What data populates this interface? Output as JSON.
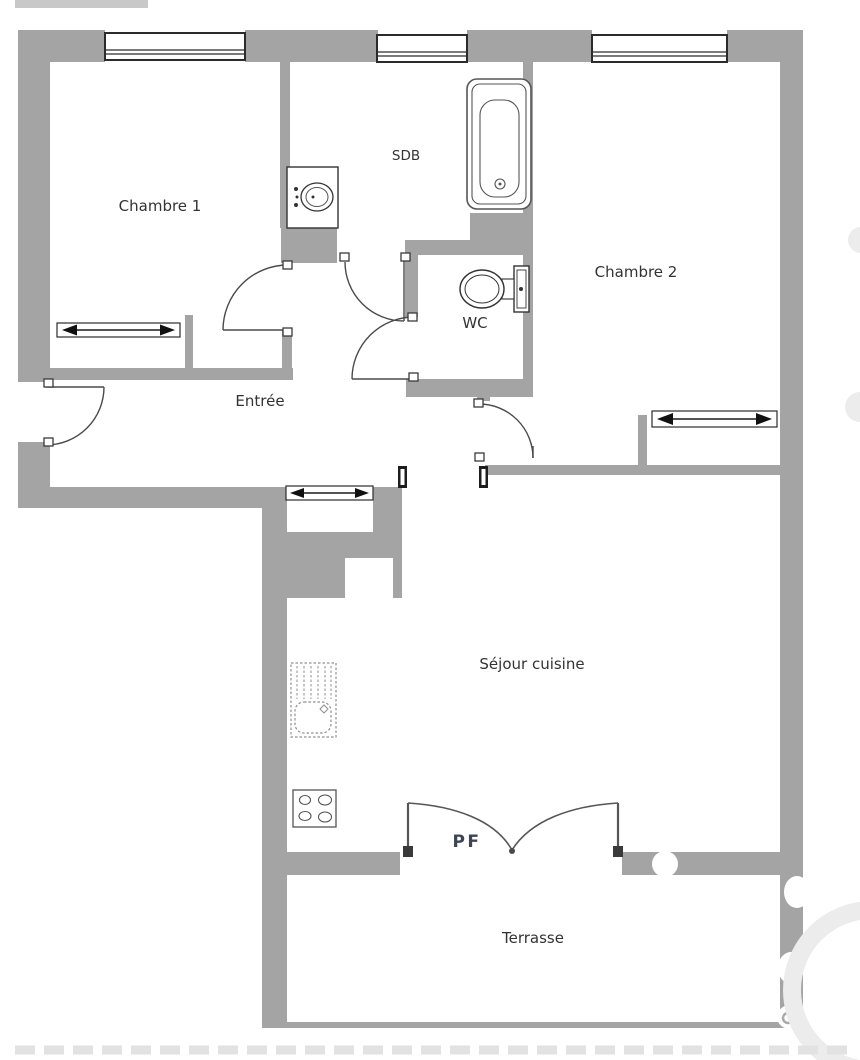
{
  "title": "Apartment floor plan",
  "colors": {
    "wall": "#a4a4a4",
    "line": "#4a4a4a",
    "label": "#333333",
    "pf_label": "#3f4455",
    "background": "#ffffff"
  },
  "rooms": {
    "chambre1": "Chambre 1",
    "sdb": "SDB",
    "chambre2": "Chambre 2",
    "wc": "WC",
    "entree": "Entrée",
    "sejour": "Séjour cuisine",
    "terrasse": "Terrasse"
  },
  "annotations": {
    "french_door": "PF"
  },
  "fixtures": {
    "bathtub-icon": "bathtub",
    "washbasin-icon": "washbasin",
    "toilet-icon": "toilet",
    "kitchen-sink-icon": "kitchen sink with drainer",
    "cooktop-icon": "4-burner cooktop",
    "sliding-wardrobe-icon": "sliding-door wardrobe (double arrow)",
    "window-icon": "window",
    "door-arc-icon": "door swing arc"
  }
}
